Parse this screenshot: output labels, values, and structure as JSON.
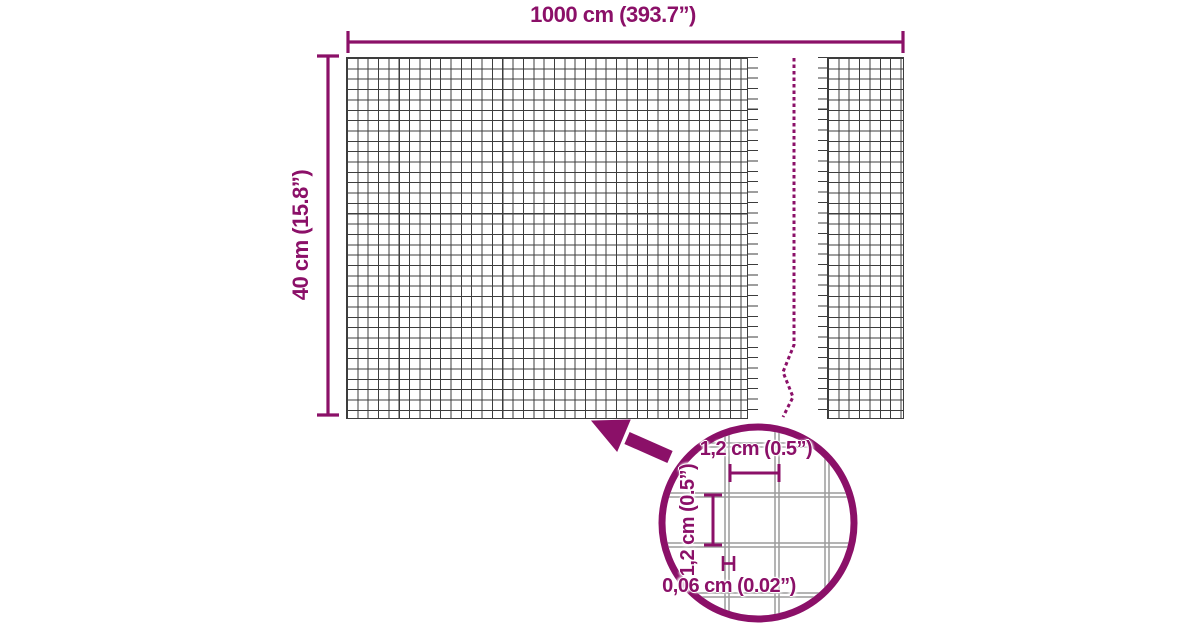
{
  "title": "Wire mesh panel dimensions diagram",
  "colors": {
    "accent": "#8b1068",
    "mesh_line": "#3d3d3d",
    "detail_wire": "#9c9c9c",
    "background": "#ffffff"
  },
  "dimensions": {
    "width_label": "1000 cm (393.7”)",
    "height_label": "40 cm (15.8”)"
  },
  "detail_view": {
    "mesh_width_label": "1,2 cm (0.5”)",
    "mesh_height_label": "1,2 cm (0.5”)",
    "wire_thickness_label": "0,06 cm (0.02”)"
  }
}
